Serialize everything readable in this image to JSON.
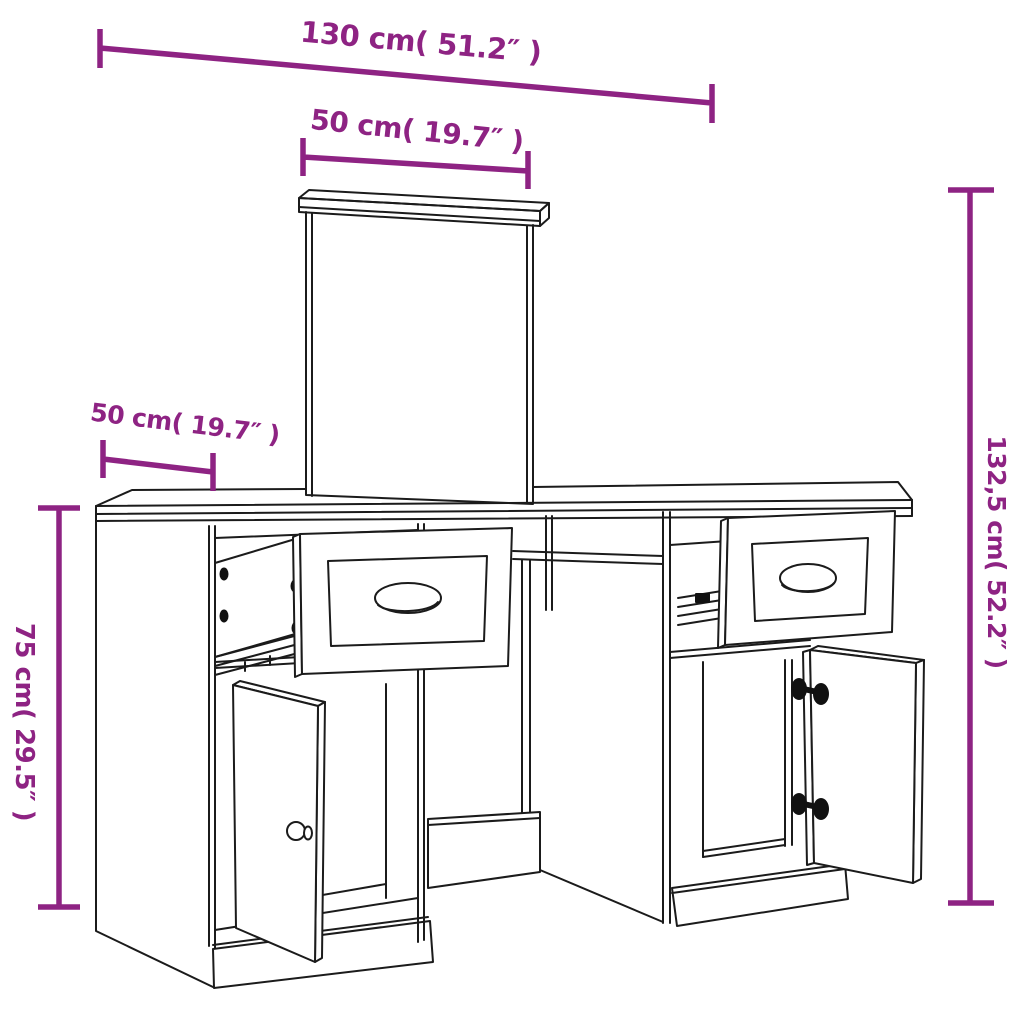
{
  "diagram": {
    "type": "furniture-dimension-diagram",
    "subject": "dressing-table-with-mirror",
    "colors": {
      "dimension_accent": "#8E2383",
      "outline": "#1B1B1B",
      "background": "#FFFFFF"
    },
    "dimensions": {
      "overall_width": {
        "label": "130 cm( 51.2″ )",
        "cm": 130,
        "inches": 51.2
      },
      "mirror_width": {
        "label": "50 cm( 19.7″ )",
        "cm": 50,
        "inches": 19.7
      },
      "depth": {
        "label": "50 cm( 19.7″ )",
        "cm": 50,
        "inches": 19.7
      },
      "table_height": {
        "label": "75 cm( 29.5″ )",
        "cm": 75,
        "inches": 29.5
      },
      "total_height": {
        "label": "132,5 cm( 52.2″ )",
        "cm": 132.5,
        "inches": 52.2
      }
    },
    "figure_parts": [
      "mirror",
      "mirror-top-rail",
      "desktop",
      "left-pedestal",
      "left-open-drawer",
      "left-open-door",
      "door-knob",
      "center-foot",
      "right-pedestal",
      "right-open-drawer",
      "right-open-door",
      "door-hinges",
      "plinth"
    ]
  }
}
